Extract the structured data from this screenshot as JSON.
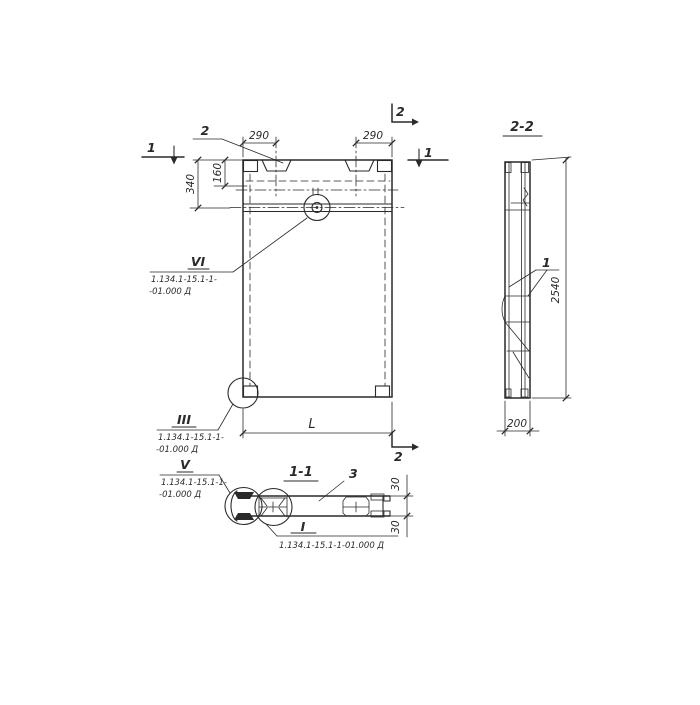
{
  "colors": {
    "ink": "#2a2a2a",
    "paper": "#ffffff"
  },
  "front_view": {
    "marks": {
      "cut_1_left": "1",
      "cut_1_right": "1",
      "cut_2_top": "2",
      "cut_2_bottom": "2"
    },
    "leaders": {
      "embed_label": "2"
    },
    "dims": {
      "top_left": "290",
      "top_right": "290",
      "left_outer": "340",
      "left_inner": "160",
      "bottom_length": "L"
    },
    "details": {
      "vi": {
        "label": "VI",
        "doc1": "1.134.1-15.1-1-",
        "doc2": "-01.000 Д"
      },
      "iii": {
        "label": "III",
        "doc1": "1.134.1-15.1-1-",
        "doc2": "-01.000 Д"
      }
    }
  },
  "section_2_2": {
    "title": "2-2",
    "leaders": {
      "item_1": "1"
    },
    "dims": {
      "height": "2540",
      "width": "200"
    }
  },
  "section_1_1": {
    "title": "1-1",
    "leaders": {
      "item_3": "3"
    },
    "dims": {
      "layer_top": "30",
      "layer_bottom": "30"
    },
    "details": {
      "v": {
        "label": "V",
        "doc1": "1.134.1-15.1-1-",
        "doc2": "-01.000 Д"
      },
      "i": {
        "label": "I",
        "doc": "1.134.1-15.1-1-01.000 Д"
      }
    }
  }
}
